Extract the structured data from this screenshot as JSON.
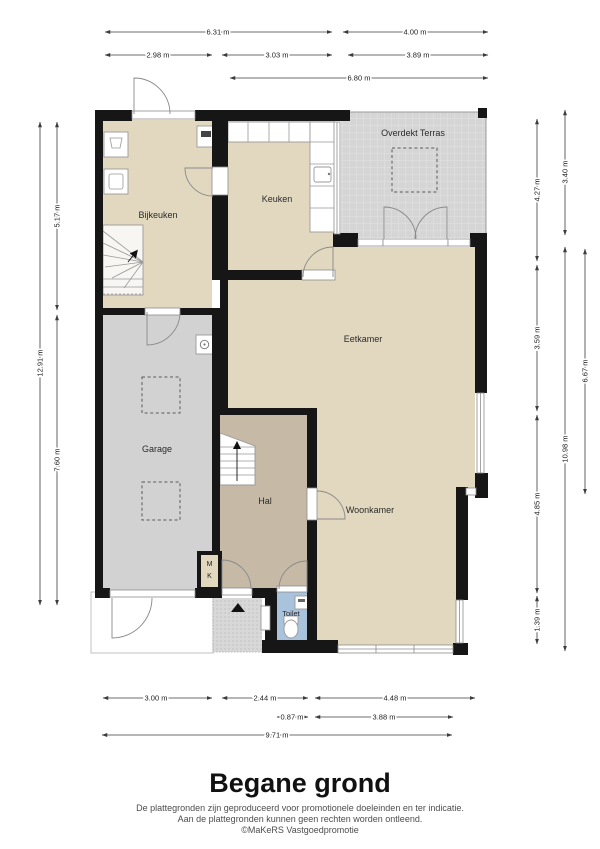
{
  "page": {
    "title": "Begane grond",
    "disclaimer_line1": "De plattegronden zijn geproduceerd voor promotionele doeleinden en ter indicatie.",
    "disclaimer_line2": "Aan de plattegronden kunnen geen rechten worden ontleend.",
    "disclaimer_line3": "©MaKeRS Vastgoedpromotie"
  },
  "rooms": {
    "bijkeuken": "Bijkeuken",
    "keuken": "Keuken",
    "overdekt_terras": "Overdekt Terras",
    "eetkamer": "Eetkamer",
    "garage": "Garage",
    "hal": "Hal",
    "woonkamer": "Woonkamer",
    "toilet": "Toilet",
    "meterkast_m": "M",
    "meterkast_k": "K"
  },
  "dims": {
    "top": [
      "6.31 m",
      "4.00 m",
      "2.98 m",
      "3.03 m",
      "3.89 m",
      "6.80 m"
    ],
    "bottom": [
      "3.00 m",
      "2.44 m",
      "4.48 m",
      "0.87 m",
      "3.88 m",
      "9.71 m"
    ],
    "left": [
      "12.91 m",
      "5.17 m",
      "7.60 m"
    ],
    "right": [
      "4.27 m",
      "3.59 m",
      "4.85 m",
      "1.39 m",
      "3.40 m",
      "10.98 m",
      "6.67 m"
    ]
  },
  "palette": {
    "wall": "#161616",
    "room_beige": "#e2d8bf",
    "hal_taupe": "#c6b9a6",
    "garage_grey": "#d2d2d2",
    "terras_grey": "#d5d5d5",
    "toilet_blue": "#a9c3dd"
  }
}
